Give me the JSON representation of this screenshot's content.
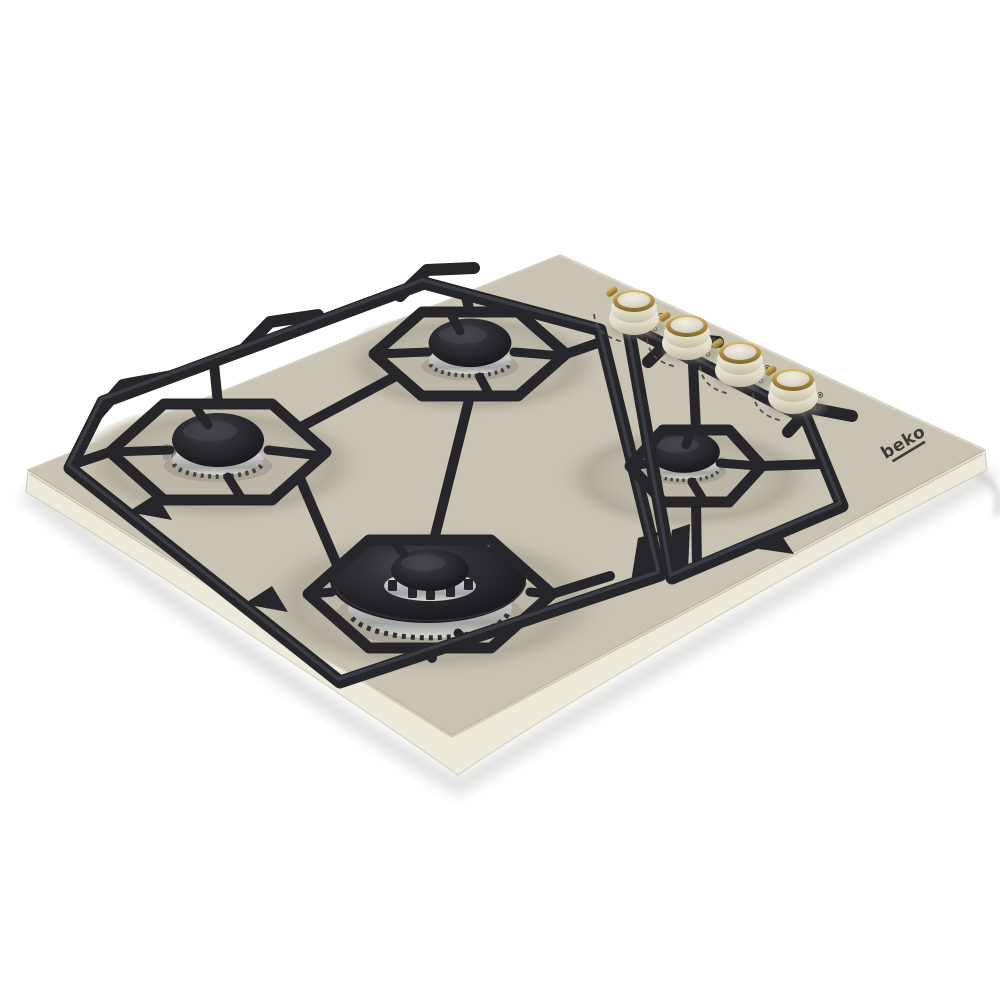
{
  "scene": {
    "kind": "product-photo",
    "subject": "Built-in 4-burner gas hob, cream enamel with black cast-iron pan supports, angled top view",
    "background_color": "#ffffff"
  },
  "brand": {
    "logo_text": "beko",
    "logo_color": "#3b3b37"
  },
  "hob": {
    "surface_color": "#c8c3b2",
    "dish_shadow_color": "#b1ac9b",
    "rim_color": "#eeeadb",
    "grate_color": "#26262a",
    "grate_highlight_color": "#41414a",
    "chrome_color": "#c9c9c9",
    "burner_cap_color": "#1f1f24",
    "burners": [
      {
        "id": "burner-left",
        "size": "medium",
        "ring": "chrome"
      },
      {
        "id": "burner-back-center",
        "size": "medium",
        "ring": "chrome"
      },
      {
        "id": "burner-right",
        "size": "small",
        "ring": "chrome"
      },
      {
        "id": "burner-front-center",
        "size": "large-wok",
        "ring": "chrome-ported"
      }
    ],
    "controls": {
      "knob_count": 4,
      "knob_body_color": "#e9e4d3",
      "knob_ring_color": "#b3924a",
      "marking_color": "#4f4e46",
      "knobs": [
        {
          "id": "knob-1",
          "icon": "flame-icon",
          "marking": "power-arc"
        },
        {
          "id": "knob-2",
          "icon": "flame-icon",
          "marking": "power-arc"
        },
        {
          "id": "knob-3",
          "icon": "flame-icon",
          "marking": "power-arc"
        },
        {
          "id": "knob-4",
          "icon": "flame-icon",
          "marking": "power-arc"
        }
      ]
    }
  }
}
